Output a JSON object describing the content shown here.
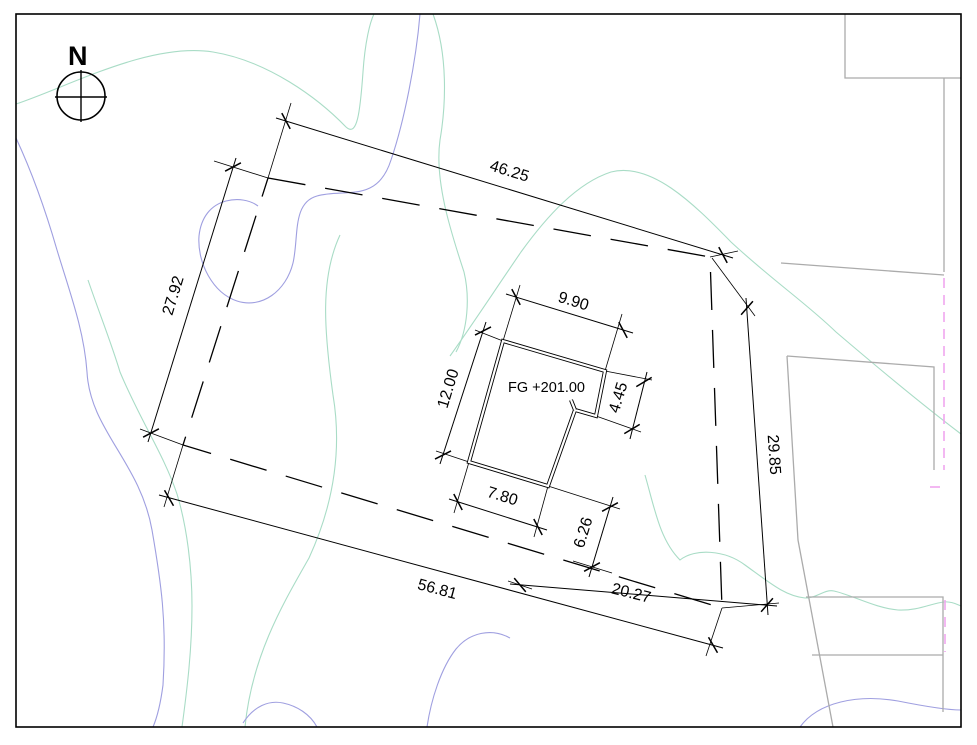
{
  "drawing": {
    "type": "site-plan",
    "labels": {
      "north": "N",
      "finished_grade": "FG +201.00"
    },
    "dims": {
      "site_top": "46.25",
      "site_left": "27.92",
      "site_bottom": "56.81",
      "site_right": "29.85",
      "bldg_top": "9.90",
      "bldg_left": "12.00",
      "bldg_right": "4.45",
      "bldg_bottom": "7.80",
      "offset_right": "6.26",
      "offset_bottom": "20.27"
    },
    "colors": {
      "line": "#000000",
      "contour_minor": "#a9dcc6",
      "contour_major": "#9f9fe0",
      "adjacent_parcel": "#ababab",
      "easement_dashed": "#f0a6ee",
      "paper": "#ffffff"
    }
  }
}
